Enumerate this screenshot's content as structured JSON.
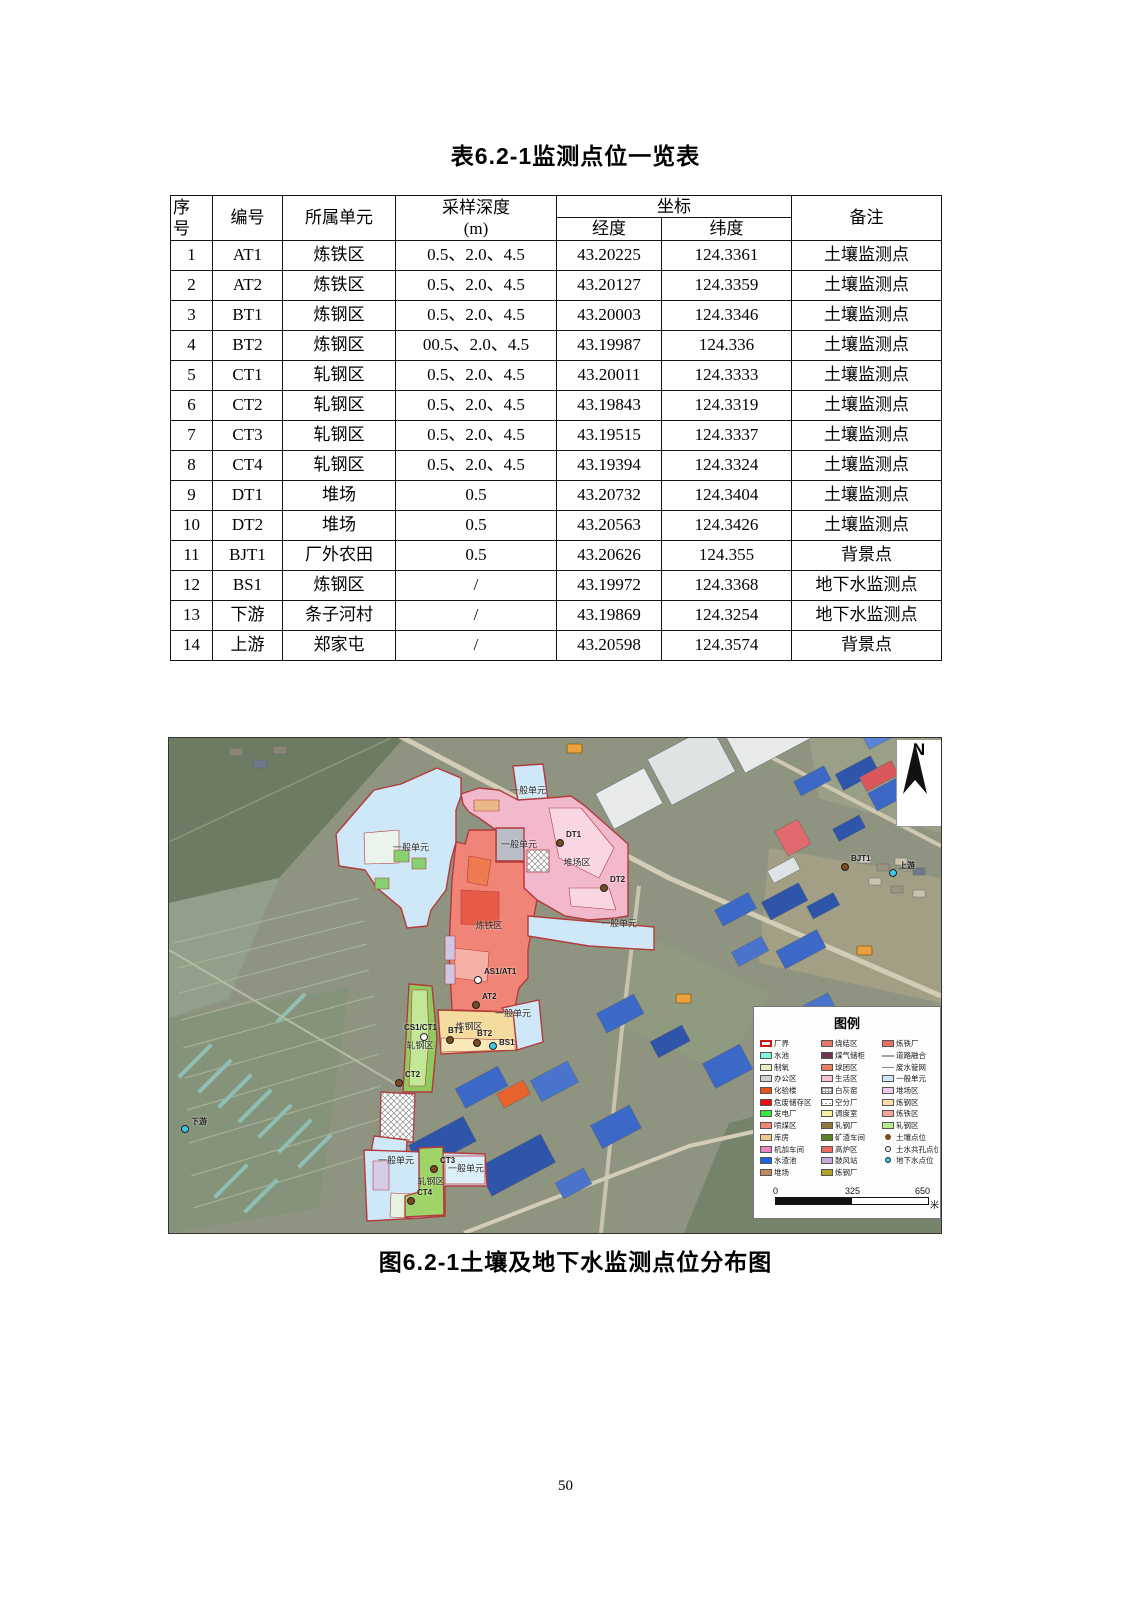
{
  "document": {
    "table_title": "表6.2-1监测点位一览表",
    "figure_caption": "图6.2-1土壤及地下水监测点位分布图",
    "page_number": "50"
  },
  "table": {
    "headers": {
      "no_line1": "序",
      "no_line2": "号",
      "code": "编号",
      "unit": "所属单元",
      "depth_line1": "采样深度",
      "depth_line2": "(m)",
      "coord": "坐标",
      "longitude": "经度",
      "latitude": "纬度",
      "remark": "备注"
    },
    "rows": [
      [
        "1",
        "AT1",
        "炼铁区",
        "0.5、2.0、4.5",
        "43.20225",
        "124.3361",
        "土壤监测点"
      ],
      [
        "2",
        "AT2",
        "炼铁区",
        "0.5、2.0、4.5",
        "43.20127",
        "124.3359",
        "土壤监测点"
      ],
      [
        "3",
        "BT1",
        "炼钢区",
        "0.5、2.0、4.5",
        "43.20003",
        "124.3346",
        "土壤监测点"
      ],
      [
        "4",
        "BT2",
        "炼钢区",
        "00.5、2.0、4.5",
        "43.19987",
        "124.336",
        "土壤监测点"
      ],
      [
        "5",
        "CT1",
        "轧钢区",
        "0.5、2.0、4.5",
        "43.20011",
        "124.3333",
        "土壤监测点"
      ],
      [
        "6",
        "CT2",
        "轧钢区",
        "0.5、2.0、4.5",
        "43.19843",
        "124.3319",
        "土壤监测点"
      ],
      [
        "7",
        "CT3",
        "轧钢区",
        "0.5、2.0、4.5",
        "43.19515",
        "124.3337",
        "土壤监测点"
      ],
      [
        "8",
        "CT4",
        "轧钢区",
        "0.5、2.0、4.5",
        "43.19394",
        "124.3324",
        "土壤监测点"
      ],
      [
        "9",
        "DT1",
        "堆场",
        "0.5",
        "43.20732",
        "124.3404",
        "土壤监测点"
      ],
      [
        "10",
        "DT2",
        "堆场",
        "0.5",
        "43.20563",
        "124.3426",
        "土壤监测点"
      ],
      [
        "11",
        "BJT1",
        "厂外农田",
        "0.5",
        "43.20626",
        "124.355",
        "背景点"
      ],
      [
        "12",
        "BS1",
        "炼钢区",
        "/",
        "43.19972",
        "124.3368",
        "地下水监测点"
      ],
      [
        "13",
        "下游",
        "条子河村",
        "/",
        "43.19869",
        "124.3254",
        "地下水监测点"
      ],
      [
        "14",
        "上游",
        "郑家屯",
        "/",
        "43.20598",
        "124.3574",
        "背景点"
      ]
    ]
  },
  "figure": {
    "north_label": "N",
    "zone_labels": [
      "一般单元",
      "一般单元",
      "一般单元",
      "堆场区",
      "一般单元",
      "炼铁区",
      "一般单元",
      "炼钢区",
      "轧钢区",
      "一般单元",
      "一般单元",
      "轧钢区"
    ],
    "points": [
      {
        "label": "DT1",
        "type": "soil"
      },
      {
        "label": "DT2",
        "type": "soil"
      },
      {
        "label": "AS1/AT1",
        "type": "shared"
      },
      {
        "label": "AT2",
        "type": "soil"
      },
      {
        "label": "CS1/CT1",
        "type": "shared"
      },
      {
        "label": "BT1",
        "type": "soil"
      },
      {
        "label": "BT2",
        "type": "soil"
      },
      {
        "label": "BS1",
        "type": "gw"
      },
      {
        "label": "CT2",
        "type": "soil"
      },
      {
        "label": "CT3",
        "type": "soil"
      },
      {
        "label": "CT4",
        "type": "soil"
      },
      {
        "label": "BJT1",
        "type": "soil"
      },
      {
        "label": "上游",
        "type": "gw"
      },
      {
        "label": "下游",
        "type": "gw"
      }
    ],
    "legend": {
      "title": "图例",
      "col1": [
        {
          "label": "厂界",
          "sw": "outline"
        },
        {
          "label": "水池",
          "sw": "#7ff5e0"
        },
        {
          "label": "制氧",
          "sw": "#e4f2c2"
        },
        {
          "label": "办公区",
          "sw": "#d2d2d2"
        },
        {
          "label": "化验楼",
          "sw": "#e35416"
        },
        {
          "label": "危废储存区",
          "sw": "#f00a0a"
        },
        {
          "label": "发电厂",
          "sw": "#3ae83a"
        },
        {
          "label": "喷煤区",
          "sw": "#f08878"
        },
        {
          "label": "库房",
          "sw": "#f2c98e"
        },
        {
          "label": "机加车间",
          "sw": "#ef86c4"
        },
        {
          "label": "水渣池",
          "sw": "#1f63e8"
        },
        {
          "label": "堆场",
          "sw": "#bd8a62"
        }
      ],
      "col2": [
        {
          "label": "烧结区",
          "sw": "#ef7468"
        },
        {
          "label": "煤气储柜",
          "sw": "#6e3452"
        },
        {
          "label": "球团区",
          "sw": "#ef7d62"
        },
        {
          "label": "生活区",
          "sw": "#f6c2d2"
        },
        {
          "label": "白灰窑",
          "sw": "grid"
        },
        {
          "label": "空分厂",
          "sw": "hatch"
        },
        {
          "label": "调度室",
          "sw": "#f4f2a2"
        },
        {
          "label": "轧钢厂",
          "sw": "#8d7840"
        },
        {
          "label": "矿渣车间",
          "sw": "#5a8422"
        },
        {
          "label": "高炉区",
          "sw": "#ee6a5e"
        },
        {
          "label": "鼓风站",
          "sw": "#c6aade"
        },
        {
          "label": "炼钢厂",
          "sw": "#b2a226"
        }
      ],
      "col3": [
        {
          "label": "炼铁厂",
          "sw": "#ee6e64"
        },
        {
          "label": "道路融合",
          "sw": "arrow"
        },
        {
          "label": "废水管网",
          "sw": "line"
        },
        {
          "label": "一般单元",
          "sw": "#cfe8f7"
        },
        {
          "label": "堆场区",
          "sw": "#efc8ec"
        },
        {
          "label": "炼钢区",
          "sw": "#f6dda6"
        },
        {
          "label": "炼铁区",
          "sw": "#f4a49c"
        },
        {
          "label": "轧钢区",
          "sw": "#b6ee8e"
        },
        {
          "label": "土壤点位",
          "sw": "dot-soil"
        },
        {
          "label": "土水共孔点位",
          "sw": "dot-shared"
        },
        {
          "label": "地下水点位",
          "sw": "dot-gw"
        }
      ]
    },
    "scale": {
      "tick0": "0",
      "tick1": "325",
      "tick2": "650",
      "unit": "米"
    }
  }
}
